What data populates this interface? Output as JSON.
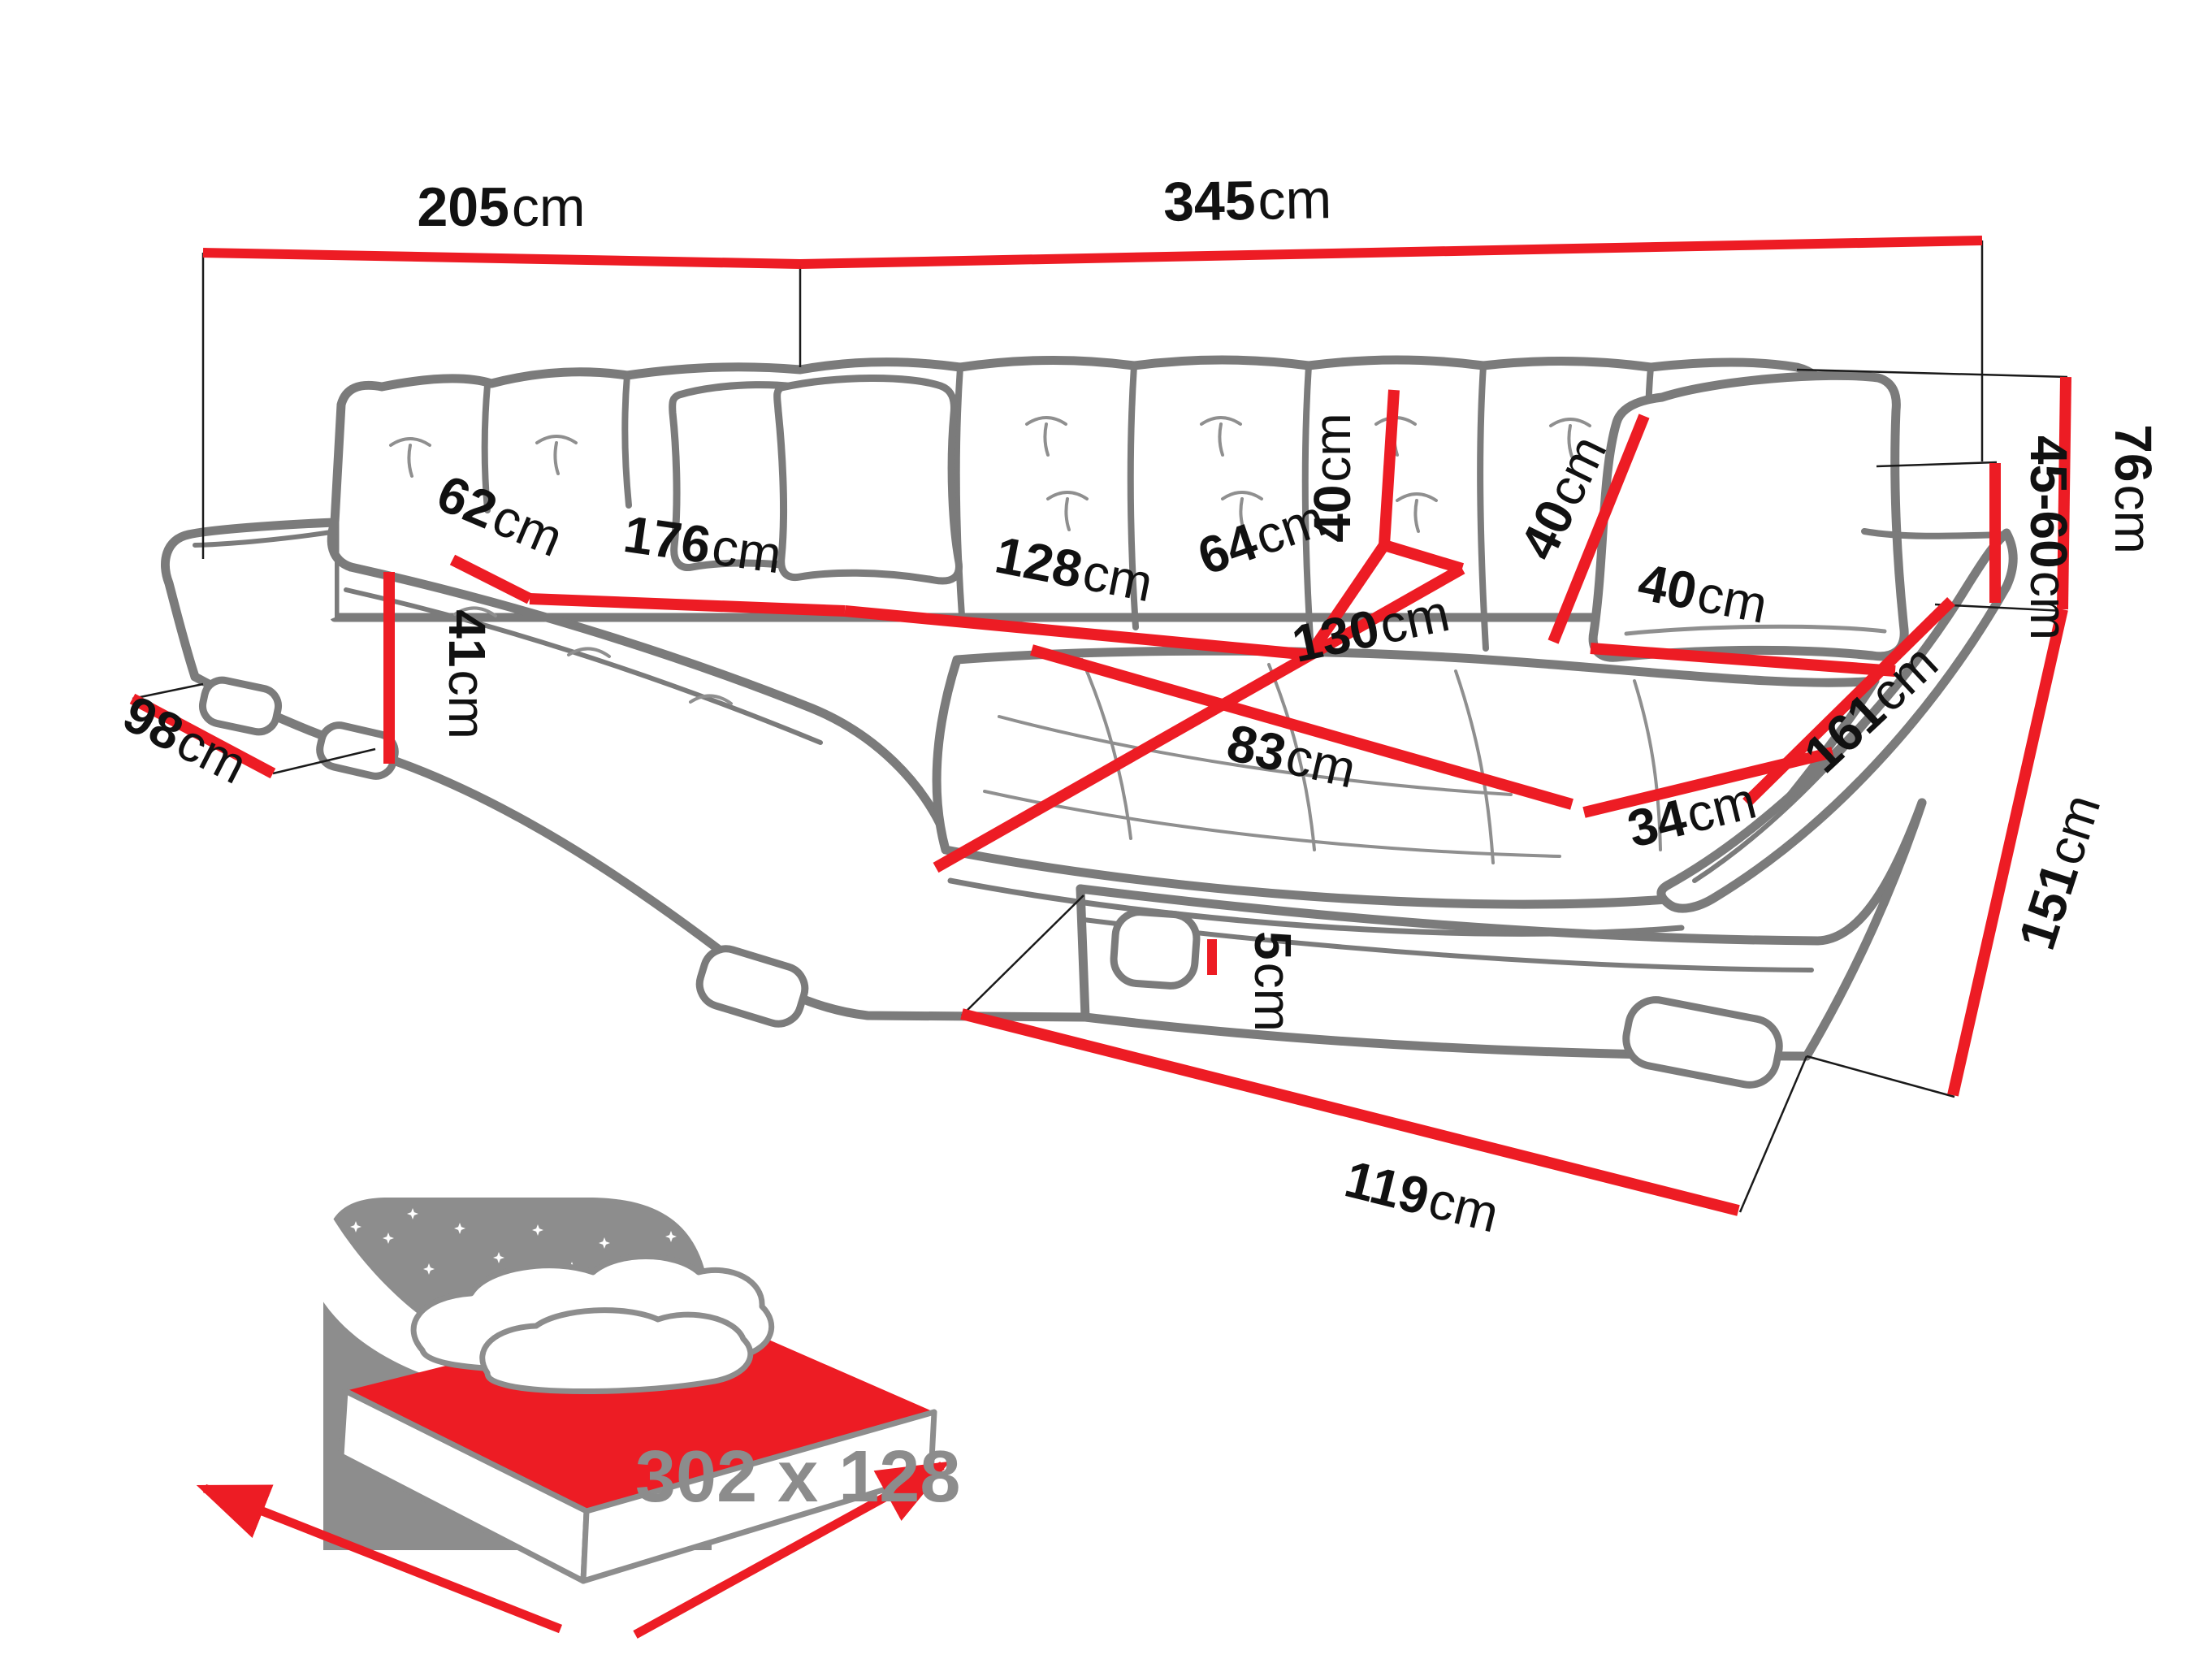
{
  "diagram": {
    "type": "corner-sofa-dimension-diagram",
    "unit": "cm",
    "dimensions": {
      "total_width_left": {
        "value": "205",
        "unit": "cm"
      },
      "total_width_right": {
        "value": "345",
        "unit": "cm"
      },
      "left_side_depth": {
        "value": "98",
        "unit": "cm"
      },
      "seat_height": {
        "value": "41",
        "unit": "cm"
      },
      "left_seat_depth": {
        "value": "62",
        "unit": "cm"
      },
      "left_seat_length": {
        "value": "176",
        "unit": "cm"
      },
      "back_seat_length": {
        "value": "128",
        "unit": "cm"
      },
      "corner_seat_depth": {
        "value": "64",
        "unit": "cm"
      },
      "backrest_cushion_height": {
        "value": "40",
        "unit": "cm"
      },
      "pillow_height": {
        "value": "40",
        "unit": "cm"
      },
      "pillow_width": {
        "value": "40",
        "unit": "cm"
      },
      "corner_seat_width": {
        "value": "130",
        "unit": "cm"
      },
      "chaise_seat_width": {
        "value": "83",
        "unit": "cm"
      },
      "armrest_front_width": {
        "value": "34",
        "unit": "cm"
      },
      "armrest_length": {
        "value": "161",
        "unit": "cm"
      },
      "armrest_height_range": {
        "value": "45-60",
        "unit": "cm"
      },
      "total_height": {
        "value": "76",
        "unit": "cm"
      },
      "right_side_depth": {
        "value": "151",
        "unit": "cm"
      },
      "leg_height": {
        "value": "5",
        "unit": "cm"
      },
      "front_width": {
        "value": "119",
        "unit": "cm"
      }
    },
    "sleeping_area": {
      "label": "302 x 128"
    },
    "colors": {
      "dimension_line": "#ed1c24",
      "sofa_outline": "#7b7b7b",
      "label_text": "#111111",
      "helper_line": "#1a1a1a",
      "sleeping_text": "#8c8c8c",
      "icon_gray": "#8d8d8d"
    }
  }
}
